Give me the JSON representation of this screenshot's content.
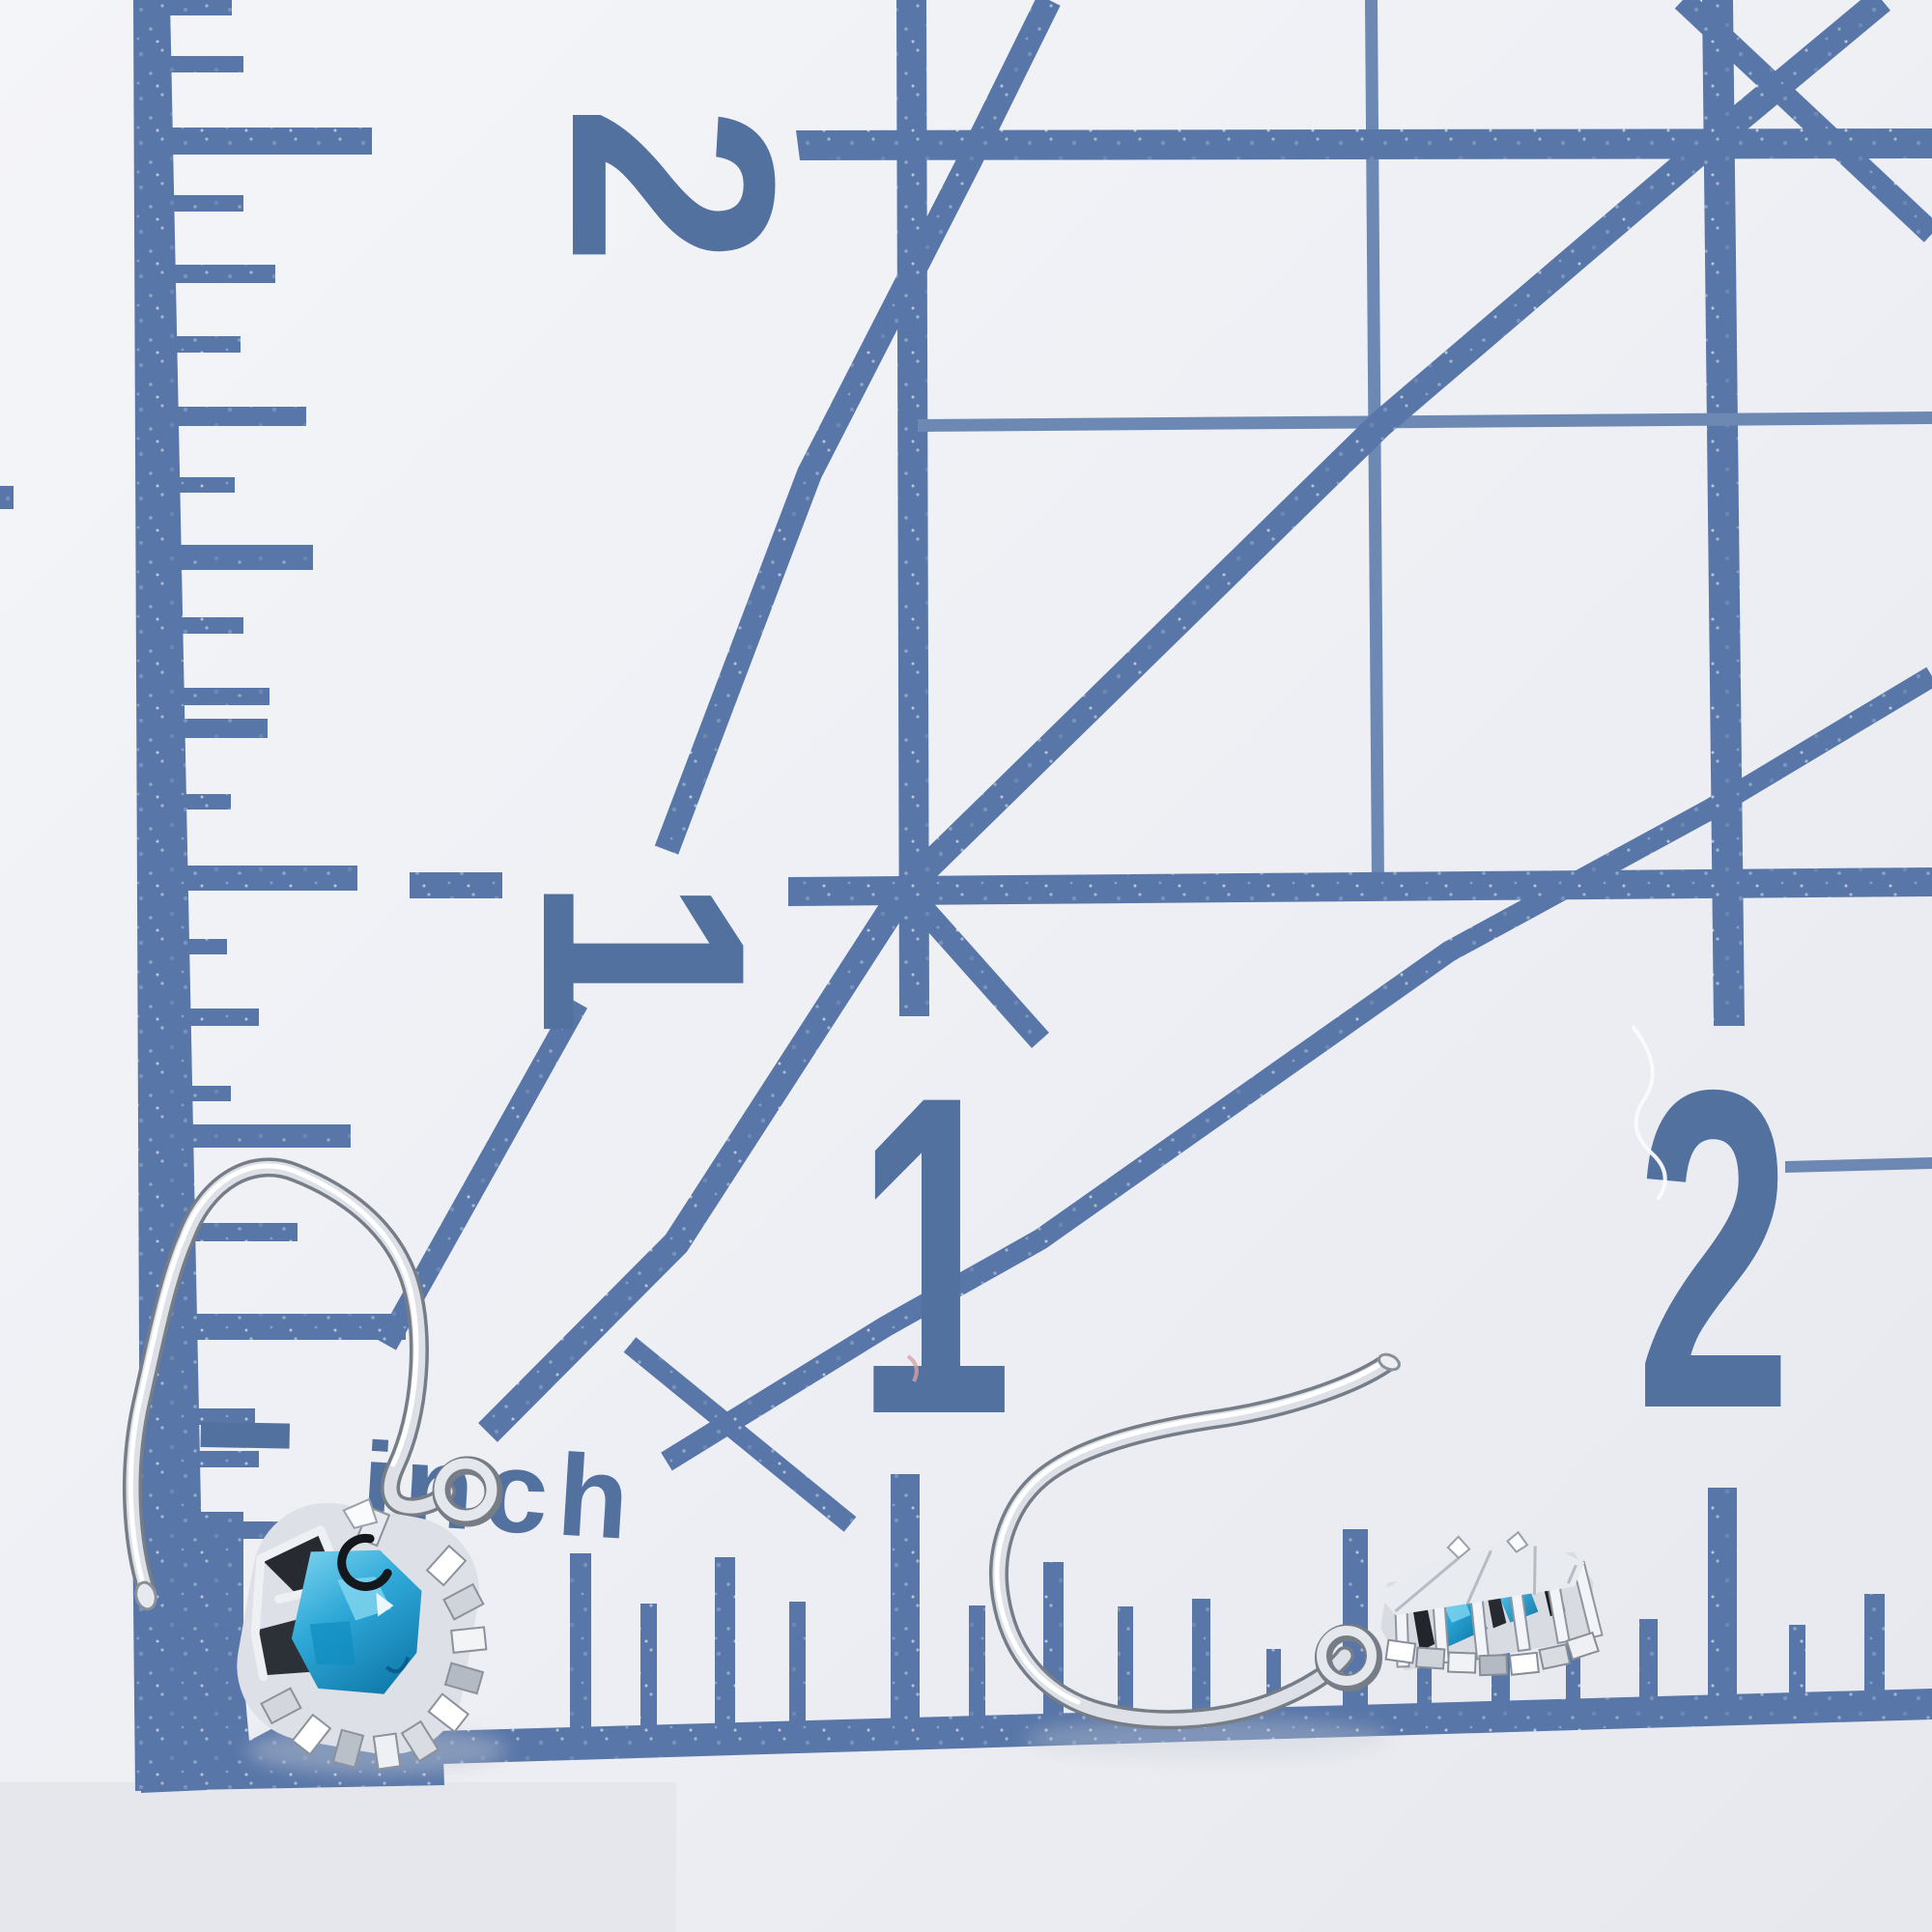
{
  "scene": {
    "description": "Photograph of a pair of silver hook earrings with blue topaz halo pendants lying on a white quilting ruler grid printed in blue, with inch markings",
    "background_color": "#eef0f4",
    "shadow_color": "#c9cdd5"
  },
  "mat": {
    "line_color": "#5876a8",
    "thin_line_color": "#6e88b4",
    "digit_color": "#53719f",
    "unit_label": "inch",
    "side_numbers": [
      "2",
      "1"
    ],
    "bottom_numbers": [
      "1",
      "2"
    ]
  },
  "earrings": {
    "metal_color": "#d4d9df",
    "metal_highlight": "#ffffff",
    "metal_shadow": "#767d87",
    "gem_color": "#2fa9d8",
    "gem_deep": "#0c6d9e",
    "gem_light": "#aee4f5",
    "halo_color": "#e8ebef",
    "left_earring": "hook-earring-with-topaz-halo-pendant",
    "right_earring": "hook-earring-with-topaz-halo-pendant"
  }
}
